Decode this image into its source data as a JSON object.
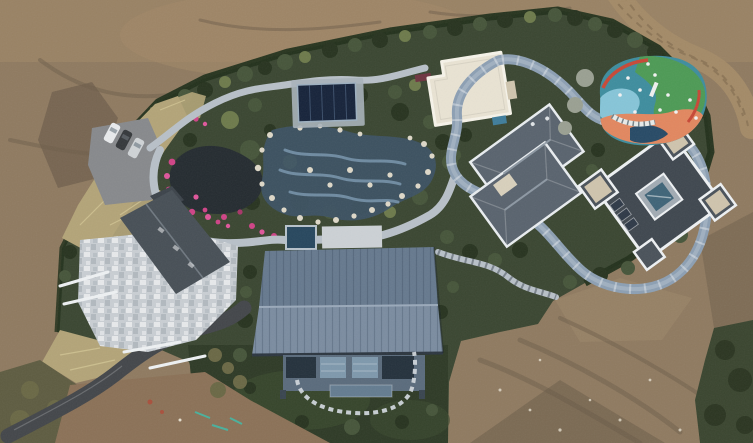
{
  "meta": {
    "type": "aerial-drone-photograph",
    "description": "Overhead aerial view of a landscaped private estate compound surrounded by bare graded earth",
    "width_px": 753,
    "height_px": 443
  },
  "palette": {
    "dirt_base": "#8f7a60",
    "dirt_road": "#a38a67",
    "hedge": "#22301b",
    "garden_base": "#3a4631",
    "grass_dark": "#2e3a26",
    "bush_dark": "#27331f",
    "bush_mid": "#46553a",
    "bush_light": "#6d7a4b",
    "dry_grass": "#b3a478",
    "dry_grass_light": "#d2c594",
    "path_stone": "#b8c0c8",
    "road_blue": "#8c9fb3",
    "asphalt": "#43464a",
    "pond_dark": "#242b30",
    "water_pool": "#3d5264",
    "pool_tile": "#6f8ba1",
    "flower_pink": "#cf4386",
    "rock_white": "#ded8c8",
    "paver_light": "#c9ced3",
    "roof_blue_upper": "#66798e",
    "roof_blue_lower": "#7b8ca0",
    "roof_gray": "#59636e",
    "roof_gray_dark": "#3f474f",
    "roof_slate_left": "#474f56",
    "white_trim": "#eef1f3",
    "cream_roof": "#e9e3d3",
    "navy_roof": "#16233a",
    "wall_blue": "#5a6b7c",
    "window_dark": "#24313c",
    "window_glass": "#7e98ac",
    "spa_blue": "#27475e",
    "skylight_blue": "#3f6478",
    "play_teal": "#3e8d9e",
    "play_green": "#4d9a55",
    "play_orange": "#e2875f",
    "play_red": "#c74836",
    "play_lightblue": "#86c5d8",
    "play_navy": "#274a66",
    "car_white": "#e8eaec",
    "car_dark": "#35383b",
    "car_silver": "#cfd3d6"
  },
  "scene": {
    "regions": [
      "bare graded earth surrounding the property",
      "dark boundary hedge with tree line",
      "parking pad with three parked cars (white, black, white)",
      "ornamental garden with dark pond and rock-edged pool",
      "magenta flower beds",
      "dark navy pool pavilion roof",
      "winding light stone garden paths",
      "cream flat-roofed sports building",
      "children's playground with swirled colorful rubber surface",
      "looping blue-grey track road",
      "grey hip-roofed villa (center right)",
      "courtyard villa with central skylight (far right)",
      "main barn-style house with blue standing-seam metal roof and glass lower level",
      "gabled annex with large paved courtyard (left)",
      "dark asphalt driveway from lower left",
      "dry ornamental pampas grass banks",
      "construction dirt track (top right corner)",
      "deep green lawn below main house",
      "stepping-stone arc path on lawn"
    ],
    "cars": {
      "count": 3,
      "colors": [
        "white",
        "black",
        "white"
      ]
    }
  }
}
